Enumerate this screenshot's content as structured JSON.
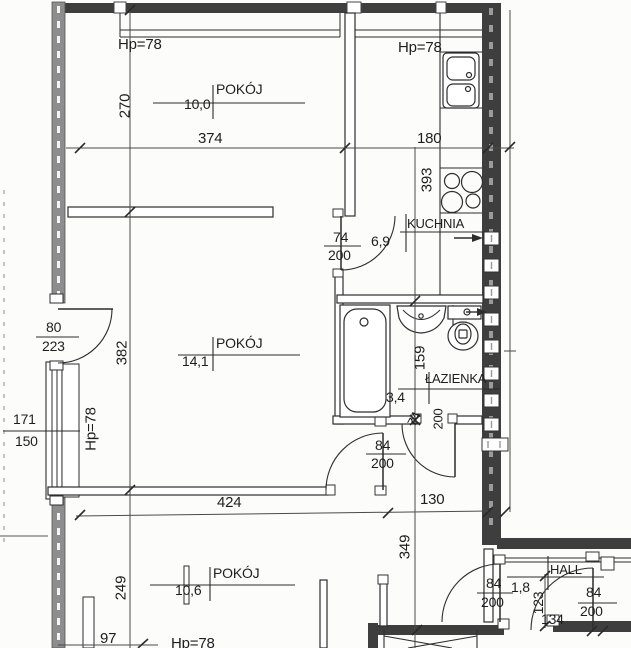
{
  "rooms": [
    {
      "name": "POKÓJ",
      "area": "10,0"
    },
    {
      "name": "KUCHNIA",
      "area": "6,9"
    },
    {
      "name": "POKÓJ",
      "area": "14,1"
    },
    {
      "name": "ŁAZIENKA",
      "area": "3,4"
    },
    {
      "name": "POKÓJ",
      "area": "10,6"
    },
    {
      "name": "HALL",
      "area": "1,8"
    }
  ],
  "dims": {
    "v270": "270",
    "h374": "374",
    "h180": "180",
    "v393": "393",
    "v382": "382",
    "v159": "159",
    "h424": "424",
    "h130": "130",
    "v349": "349",
    "v249": "249",
    "v123": "123",
    "h134": "134",
    "h97": "97",
    "sill": "Hp=78",
    "balcony_w": "80",
    "balcony_h": "223",
    "window_w": "171",
    "window_h": "150",
    "door74": "74",
    "door84": "84",
    "door_height": "200"
  }
}
